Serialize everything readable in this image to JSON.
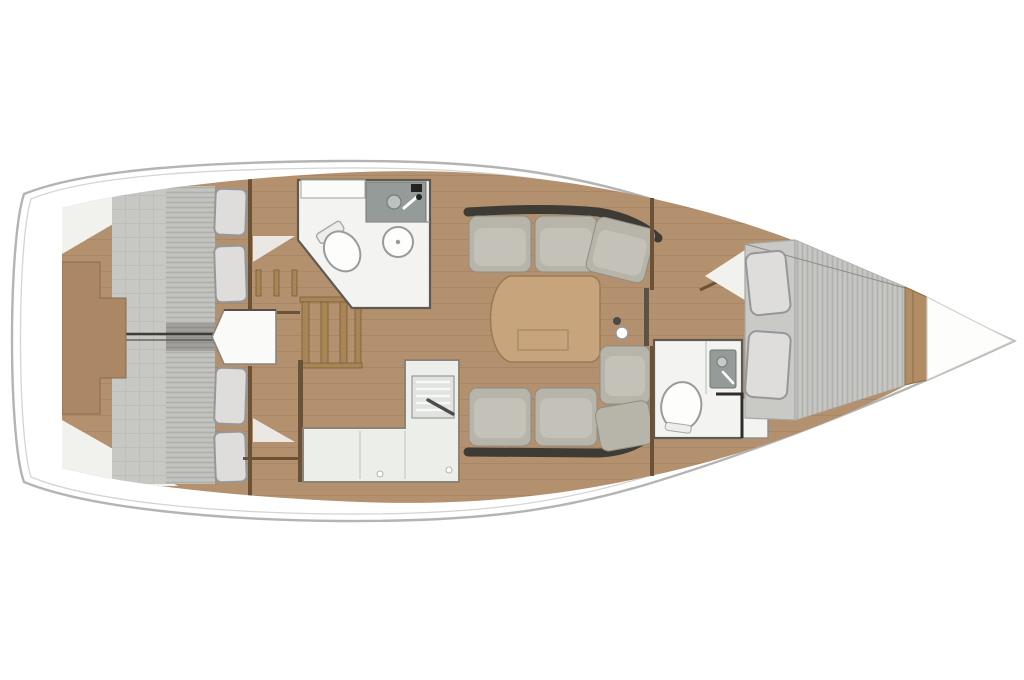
{
  "meta": {
    "title": "Sailing yacht interior layout plan",
    "view": "top-down floor plan",
    "orientation": "bow pointing right, stern at left",
    "visible_text": "none"
  },
  "colors": {
    "wood": "#b3906e",
    "pier": "#ab8765",
    "wall": "#6b5136",
    "hull_line": "#b4b4b2",
    "hull_inner_line": "#d4d4d2",
    "mattress": "#c7c7c4",
    "mattress_stripe": "#b0b0ad",
    "pillow": "#dedddb",
    "pillow_edge": "#97979b",
    "cushion": "#b7b4aa",
    "cushion_dark": "#3e3b35",
    "fixture": "#f3f4f1",
    "shower": "#949b98",
    "counter": "#eceeea",
    "table": "#c7a47c",
    "bow_trim": "#b28c63"
  },
  "features": [
    {
      "id": "hull",
      "name": "hull-outline"
    },
    {
      "id": "aft-cabin-port",
      "name": "aft double cabin with berth and pillows (top left)"
    },
    {
      "id": "aft-cabin-starboard",
      "name": "aft double cabin with berth and pillows (bottom left)"
    },
    {
      "id": "engine-compartment",
      "name": "engine compartment between aft cabins"
    },
    {
      "id": "companionway",
      "name": "companionway stairs"
    },
    {
      "id": "aft-head",
      "name": "aft bathroom with toilet, sink and shower"
    },
    {
      "id": "galley",
      "name": "L-shaped galley with stove"
    },
    {
      "id": "salon-sofa-port",
      "name": "salon sofa port side"
    },
    {
      "id": "salon-sofa-starboard",
      "name": "salon L-sofa starboard side"
    },
    {
      "id": "salon-table",
      "name": "salon table"
    },
    {
      "id": "forward-head",
      "name": "forward bathroom with toilet and shower"
    },
    {
      "id": "forward-cabin",
      "name": "forward V-berth cabin with pillows"
    },
    {
      "id": "bow",
      "name": "bow compartment"
    }
  ]
}
